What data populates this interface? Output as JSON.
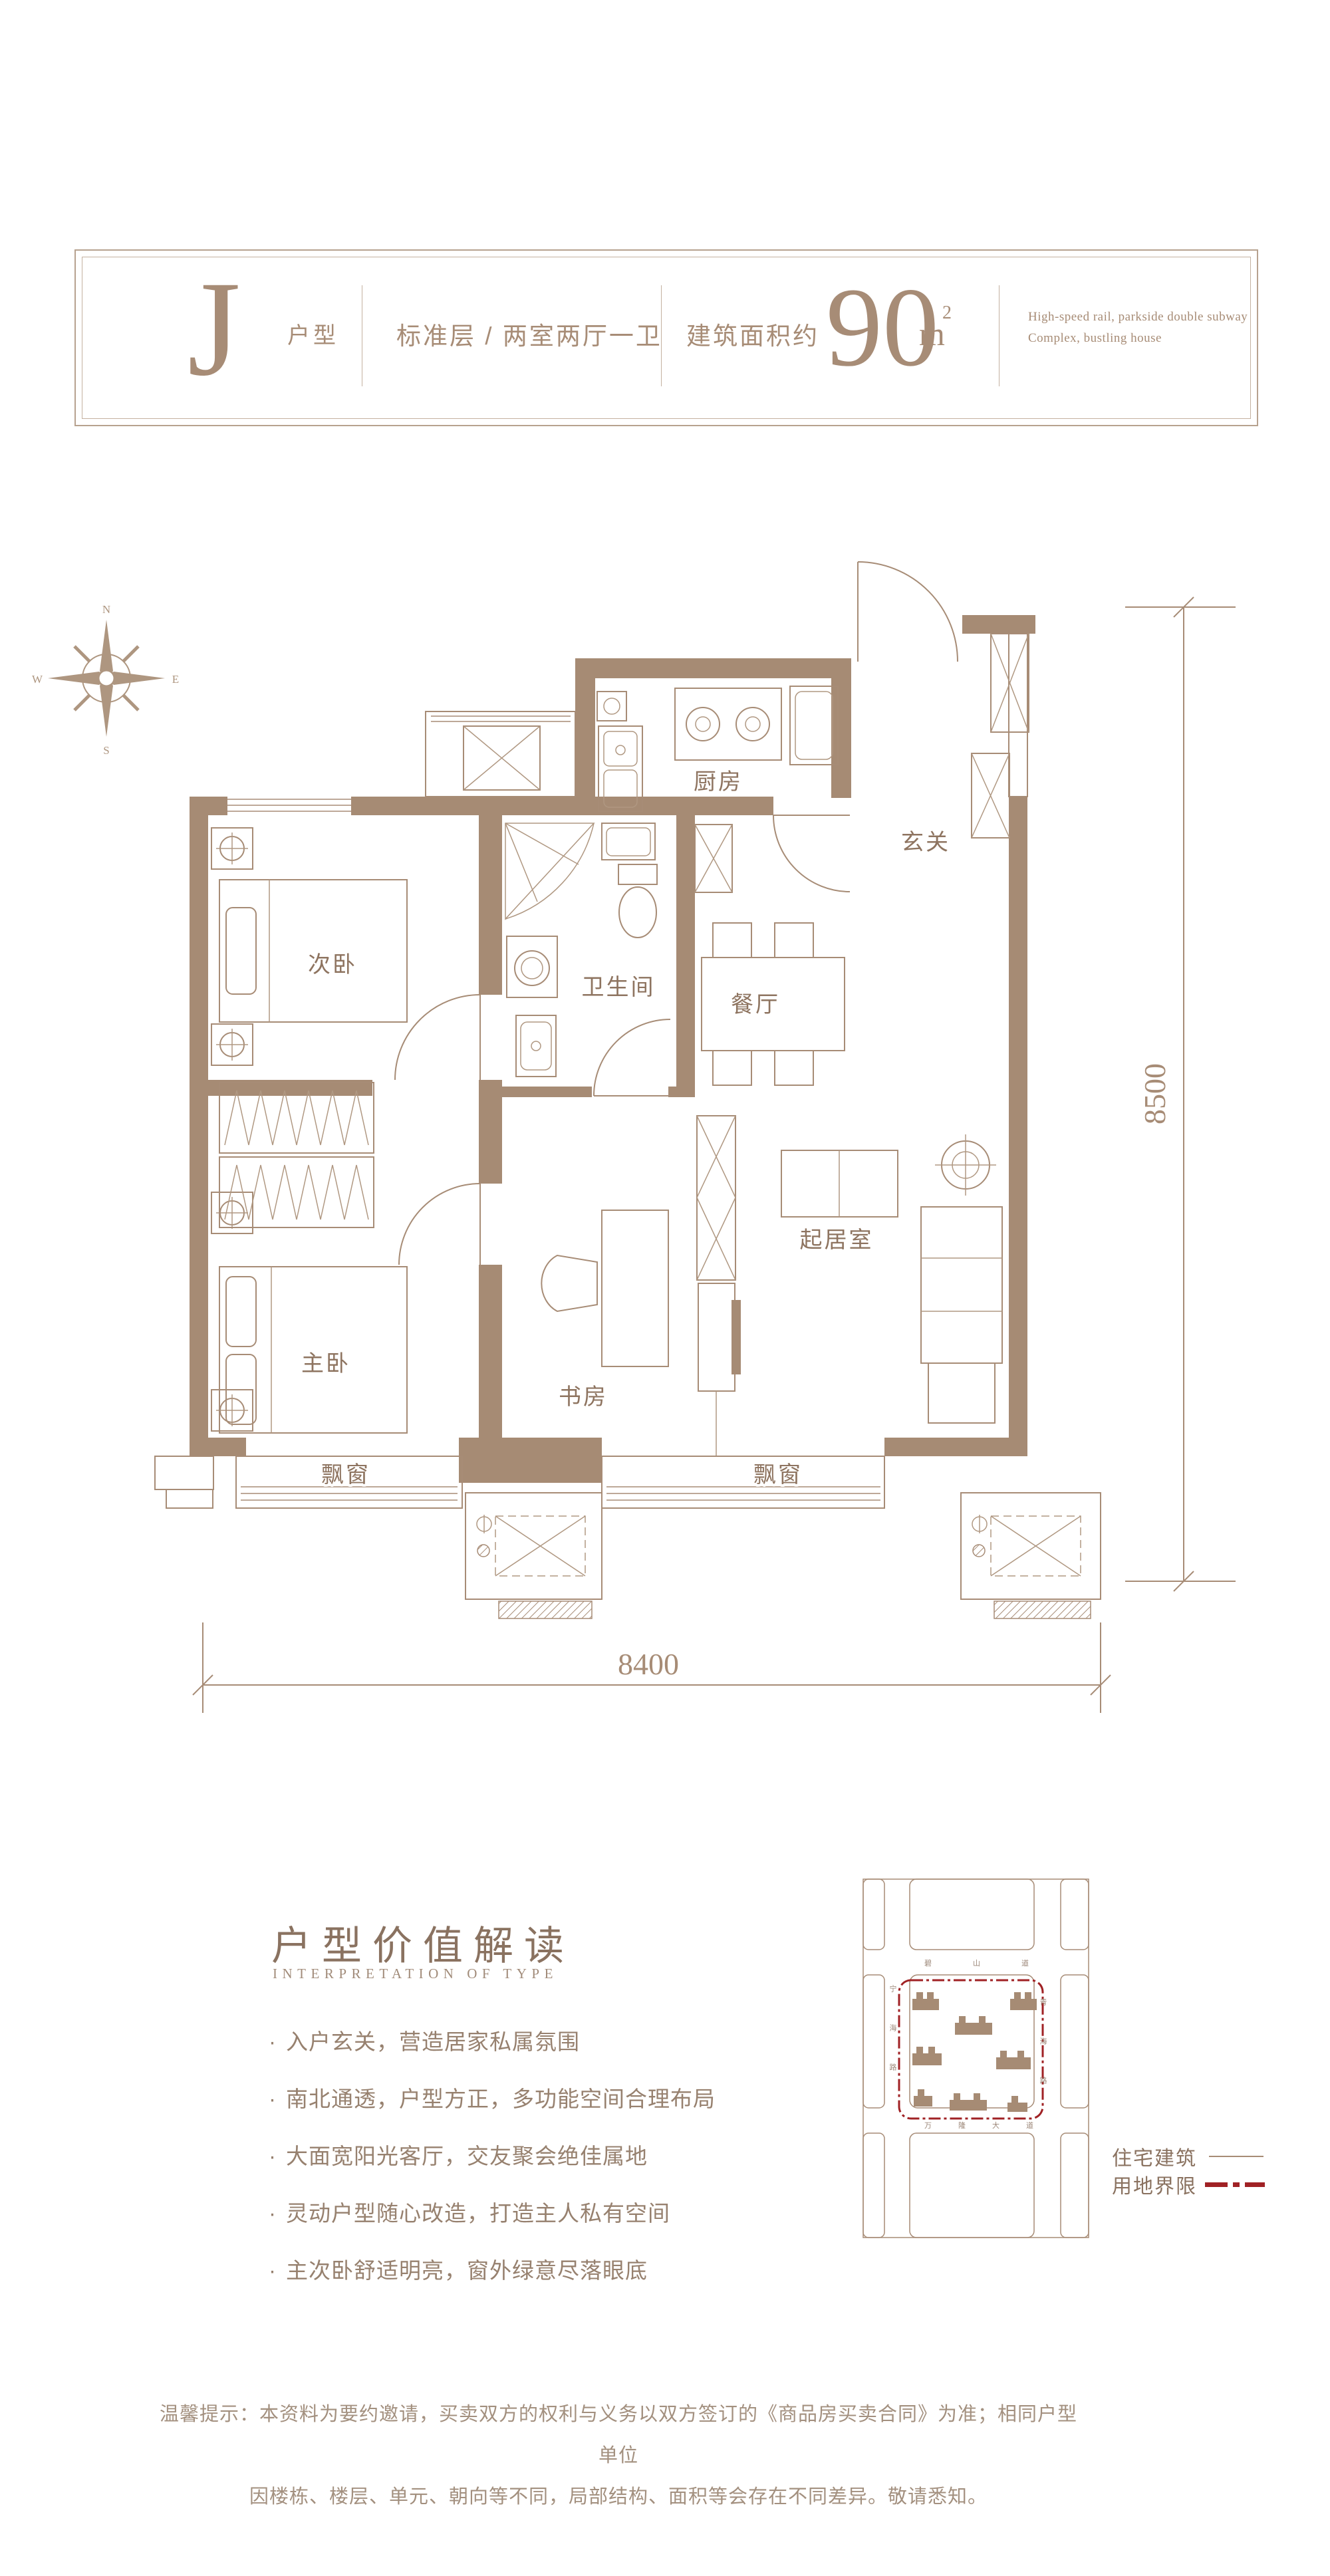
{
  "colors": {
    "wall_brown": "#A68B74",
    "line_brown": "#A78C76",
    "text_brown": "#8E7460",
    "soft_brown": "#A3907F",
    "boundary_red": "#A02225"
  },
  "header": {
    "type_letter": "J",
    "type_suffix": "户型",
    "spec": "标准层 / 两室两厅一卫",
    "area_prefix": "建筑面积约",
    "area_value": "90",
    "area_unit": "m",
    "area_sup": "2",
    "tagline_line1": "High-speed rail, parkside double subway",
    "tagline_line2": "Complex, bustling house"
  },
  "compass": {
    "north": "N",
    "east": "E",
    "south": "S",
    "west": "W"
  },
  "floorplan": {
    "rooms": {
      "kitchen": "厨房",
      "entry": "玄关",
      "second_bedroom": "次卧",
      "bathroom": "卫生间",
      "dining": "餐厅",
      "master_bedroom": "主卧",
      "study": "书房",
      "living": "起居室"
    },
    "bay_window_left": "飘窗",
    "bay_window_right": "飘窗",
    "dim_right": "8500",
    "dim_bottom": "8400"
  },
  "value_section": {
    "title": "户型价值解读",
    "subtitle": "INTERPRETATION OF TYPE",
    "bullets": [
      "入户玄关，营造居家私属氛围",
      "南北通透，户型方正，多功能空间合理布局",
      "大面宽阳光客厅，交友聚会绝佳属地",
      "灵动户型随心改造，打造主人私有空间",
      "主次卧舒适明亮，窗外绿意尽落眼底"
    ]
  },
  "sitemap": {
    "roads": {
      "top": "碧山道",
      "left": "宁海路",
      "right": "青海路",
      "bottom": "万隆大道"
    },
    "legend_building": "住宅建筑",
    "legend_boundary": "用地界限"
  },
  "disclaimer": {
    "line1": "温馨提示：本资料为要约邀请，买卖双方的权利与义务以双方签订的《商品房买卖合同》为准；相同户型单位",
    "line2": "因楼栋、楼层、单元、朝向等不同，局部结构、面积等会存在不同差异。敬请悉知。"
  }
}
